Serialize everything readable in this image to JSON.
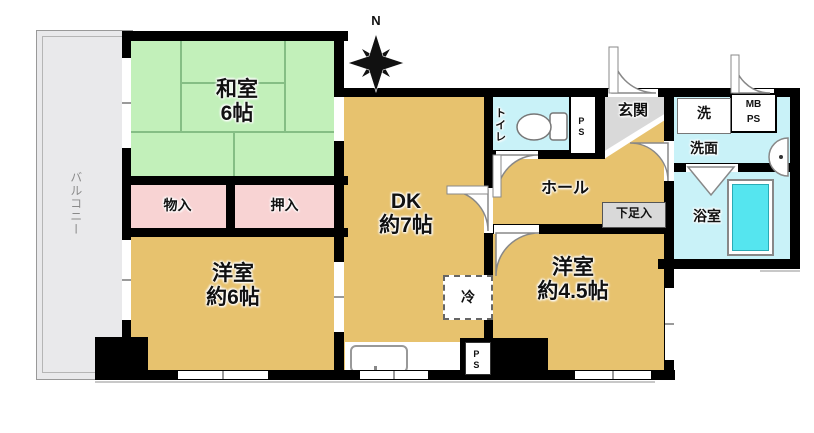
{
  "meta": {
    "type": "apartment-floor-plan"
  },
  "colors": {
    "wall": "#000000",
    "tan": "#e7c26e",
    "tatami_green": "#c2f0ba",
    "tatami_line": "#85be85",
    "closet_pink": "#f8d3d3",
    "wet_cyan": "#c9f2f8",
    "tub_cyan": "#55e5ef",
    "balcony_gray": "#e9e9eb",
    "genkan_gray": "#d9d9d9",
    "label_box_gray": "#d9d9d9"
  },
  "compass": {
    "north_label": "N"
  },
  "balcony": {
    "label": "バルコニー"
  },
  "rooms": {
    "washitsu": {
      "name": "和室",
      "size": "6帖"
    },
    "dk": {
      "name": "DK",
      "size": "約7帖"
    },
    "western6": {
      "name": "洋室",
      "size": "約6帖"
    },
    "western45": {
      "name": "洋室",
      "size": "約4.5帖"
    },
    "hall": {
      "name": "ホール"
    },
    "genkan": {
      "name": "玄関"
    },
    "toilet": {
      "name": "トイレ"
    },
    "washroom": {
      "name": "洗面"
    },
    "bathroom": {
      "name": "浴室"
    },
    "storage": {
      "name": "物入"
    },
    "closet": {
      "name": "押入"
    }
  },
  "labels": {
    "washer": "洗",
    "mb": "MB",
    "ps": "PS",
    "ps_top": "PS",
    "ps_bottom": "PS",
    "shoe_box": "下足入",
    "fridge": "冷"
  }
}
